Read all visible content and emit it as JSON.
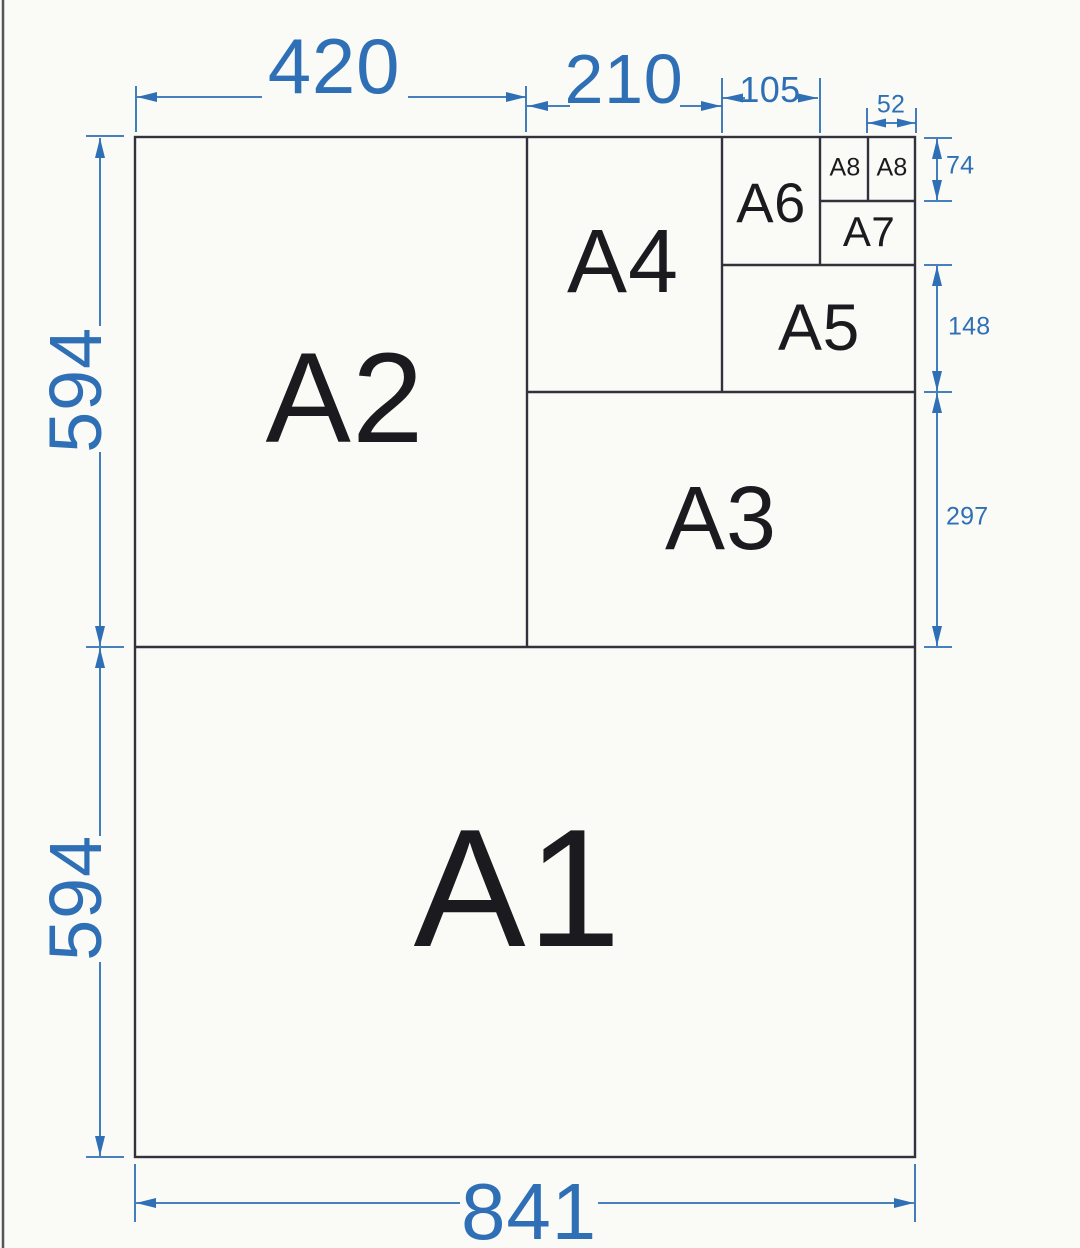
{
  "diagram": {
    "title": "A-series paper sheet subdivision drawing",
    "sheets": [
      {
        "label": "A1"
      },
      {
        "label": "A2"
      },
      {
        "label": "A3"
      },
      {
        "label": "A4"
      },
      {
        "label": "A5"
      },
      {
        "label": "A6"
      },
      {
        "label": "A7"
      },
      {
        "label": "A8"
      },
      {
        "label": "A8"
      }
    ],
    "dimensions": {
      "top": [
        {
          "value": "420"
        },
        {
          "value": "210"
        },
        {
          "value": "105"
        },
        {
          "value": "52"
        }
      ],
      "left": [
        {
          "value": "594"
        },
        {
          "value": "594"
        }
      ],
      "right": [
        {
          "value": "74"
        },
        {
          "value": "148"
        },
        {
          "value": "297"
        }
      ],
      "bottom": [
        {
          "value": "841"
        }
      ]
    },
    "colors": {
      "dimension_blue": "#2e6fb5",
      "outline_dark": "#32323c",
      "label_black": "#1b1b1f",
      "background": "#fafaf7"
    }
  }
}
